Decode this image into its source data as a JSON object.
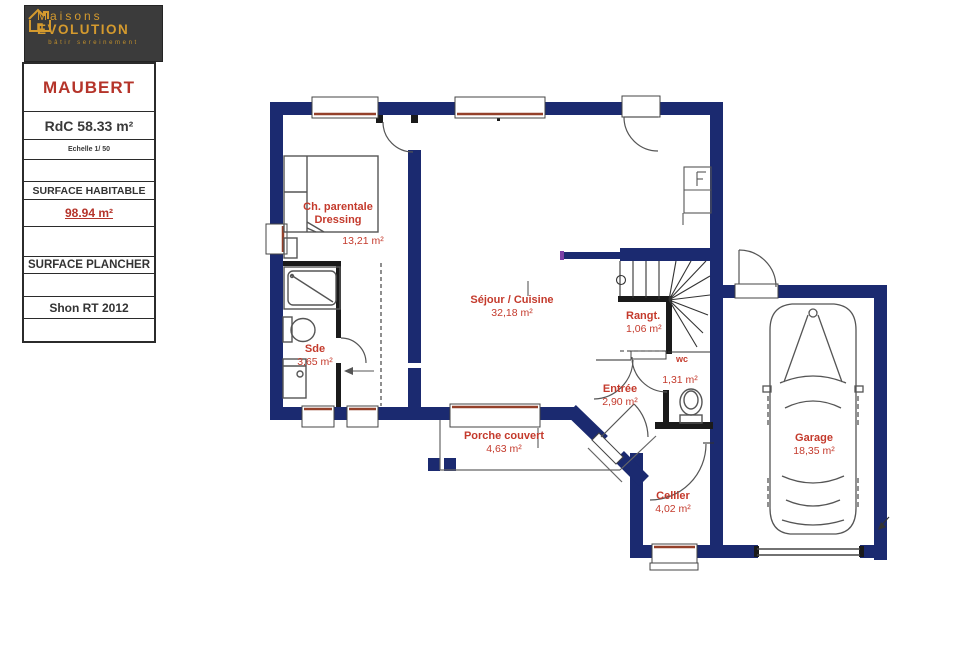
{
  "sidebar": {
    "logo": {
      "brand_top": "Maisons",
      "brand_bottom": "EVOLUTION",
      "tagline": "bâtir sereinement"
    },
    "model_name": "MAUBERT",
    "floor_label": "RdC 58.33 m²",
    "scale_label": "Echelle 1/ 50",
    "surface_habitable_label": "SURFACE HABITABLE",
    "surface_habitable_value": "98.94 m²",
    "surface_plancher_label": "SURFACE PLANCHER",
    "shon_label": "Shon RT 2012"
  },
  "plan": {
    "rooms": {
      "bedroom": {
        "name": "Ch. parentale",
        "name2": "Dressing",
        "area": "13,21 m²"
      },
      "sejour": {
        "name": "Séjour / Cuisine",
        "area": "32,18 m²"
      },
      "sde": {
        "name": "Sde",
        "area": "3,65 m²"
      },
      "rangt": {
        "name": "Rangt.",
        "area": "1,06 m²"
      },
      "wc": {
        "name": "wc",
        "area": "1,31 m²"
      },
      "entree": {
        "name": "Entrée",
        "area": "2,90 m²"
      },
      "porche": {
        "name": "Porche couvert",
        "area": "4,63 m²"
      },
      "cellier": {
        "name": "Cellier",
        "area": "4,02 m²"
      },
      "garage": {
        "name": "Garage",
        "area": "18,35 m²"
      }
    }
  },
  "colors": {
    "wall_navy": "#1b2a70",
    "label_red": "#c43a2c",
    "sill_brown": "#94402a",
    "logo_gold": "#d49a2e",
    "logo_bg": "#3b3b3b"
  }
}
